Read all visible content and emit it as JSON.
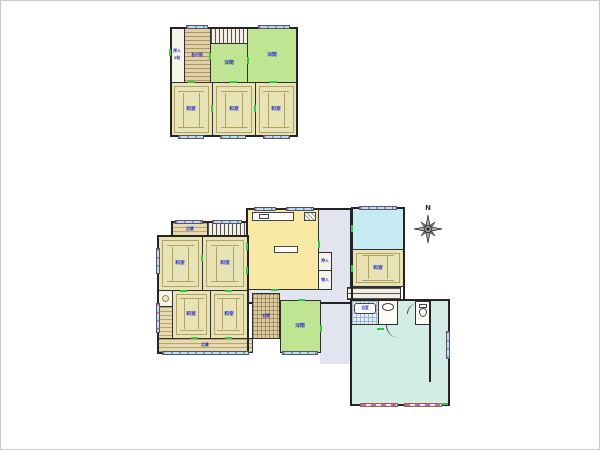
{
  "colors": {
    "wall": "#2b2b2b",
    "tatami_room": "#e8e3b5",
    "tatami_line": "#b3a268",
    "western_room": "#c0e592",
    "kitchen": "#f8e9a4",
    "cyan_room": "#c6ebf2",
    "garage_area": "#d2ece6",
    "corridor": "#e2e5f0",
    "window_glass": "#aee4f0",
    "window_tick": "#c95fc9",
    "opening_mark": "#2ecc40",
    "room_label": "#2233cc"
  },
  "floor2": {
    "closet_label_line1": "押入",
    "closet_label_line2": "2帖",
    "itanoma_label": "板の間",
    "youma_small_label": "洋間",
    "youma_large_label": "洋間",
    "washitsu_labels": [
      "和室",
      "和室",
      "和室"
    ]
  },
  "floor1": {
    "hiroen_top_label": "広縁",
    "kitchen_label": "キッチン",
    "closet_top_label": "押入",
    "closet_bottom_label": "物入",
    "washitsu_nw_label": "和室",
    "washitsu_ne_label": "和室",
    "washitsu_sw_label": "和室",
    "washitsu_se_label": "和室",
    "genkan_label": "玄関",
    "youma_label": "洋間",
    "washitsu_right_label": "和室",
    "hiroen_bottom_label": "広縁",
    "bath_label": "浴室",
    "compass_north_label": "N"
  }
}
